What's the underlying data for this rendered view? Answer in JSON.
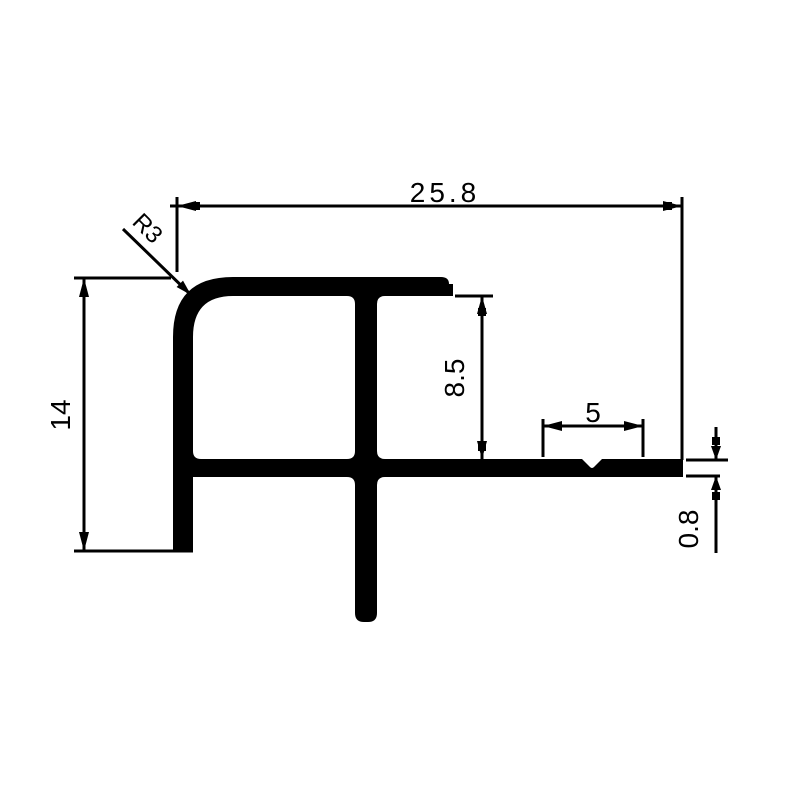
{
  "drawing": {
    "description": "Technical cross-section drawing of an aluminum stair-nosing / tile trim profile with dimension annotations",
    "background_color": "#ffffff",
    "line_color": "#000000",
    "labels": {
      "overall_width": "25.8",
      "corner_radius": "R3",
      "overall_height": "14",
      "inner_height": "8.5",
      "groove_zone_width": "5",
      "flange_thickness": "0.8"
    }
  }
}
